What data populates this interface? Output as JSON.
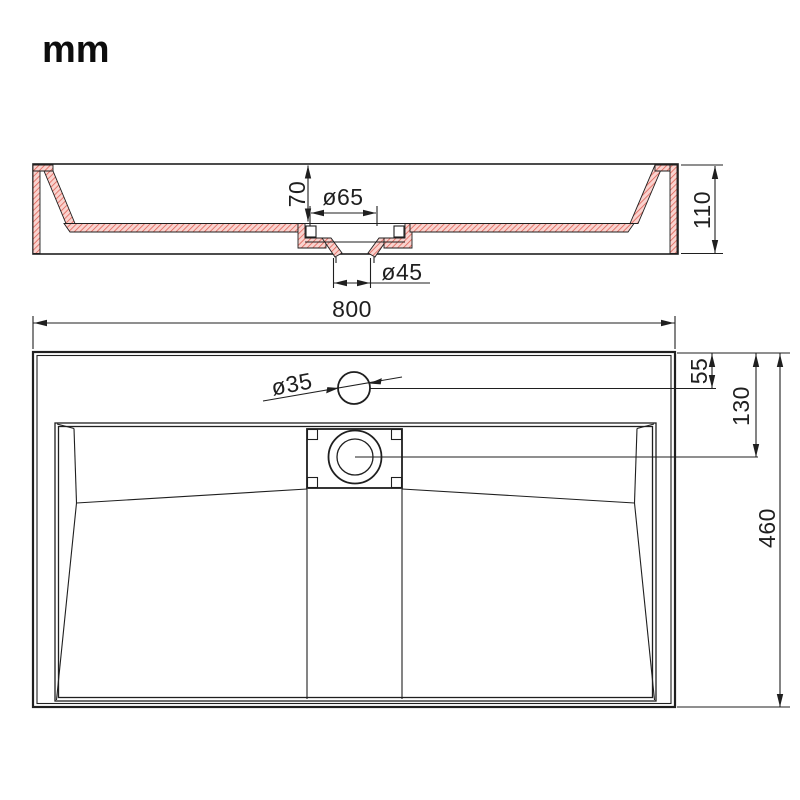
{
  "unit_label": "mm",
  "drawing": {
    "subject": "Wall-mounted rectangular washbasin with integrated drain - dimensioned technical drawing, section view and plan view",
    "colors": {
      "line": "#1f1f1f",
      "hatch_fill": "#f9d3cf",
      "hatch_stroke": "#dd5a4e"
    },
    "section_view": {
      "name": "front section view",
      "dims": {
        "basin_depth": "70",
        "drain_recess_dia": "ø65",
        "drain_outlet_dia": "ø45",
        "overall_height": "110"
      }
    },
    "plan_view": {
      "name": "top plan view",
      "dims": {
        "overall_width": "800",
        "faucet_hole_dia": "ø35",
        "faucet_offset": "55",
        "drain_offset": "130",
        "overall_depth": "460"
      }
    }
  }
}
